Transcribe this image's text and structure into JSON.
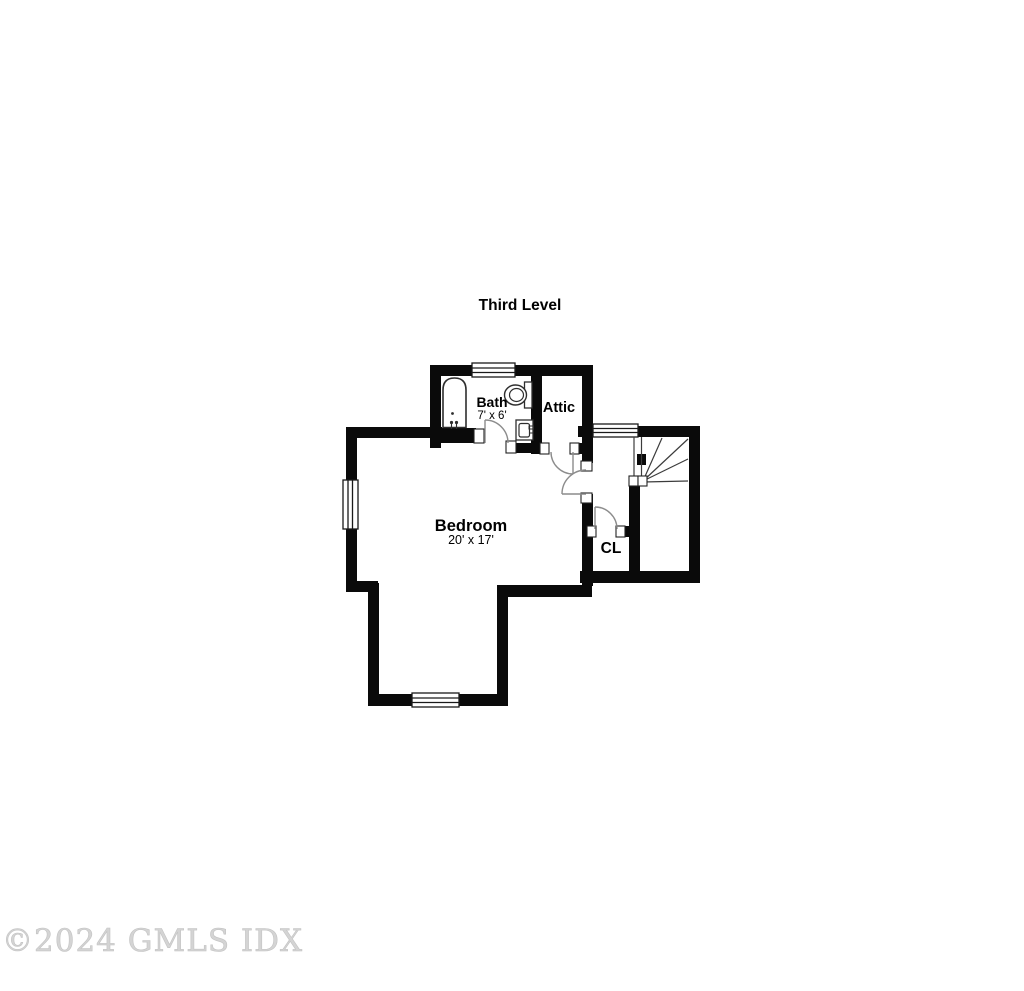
{
  "plan": {
    "title": "Third Level",
    "rooms": {
      "bath": {
        "label": "Bath",
        "dims": "7' x 6'"
      },
      "attic": {
        "label": "Attic"
      },
      "bedroom": {
        "label": "Bedroom",
        "dims": "20' x 17'"
      },
      "closet": {
        "label": "CL"
      }
    },
    "fixtures": {
      "bathtub": "bathtub-icon",
      "toilet": "toilet-icon",
      "sink": "sink-icon",
      "stairs": "winder-stairs-icon"
    },
    "counts": {
      "windows": "4",
      "doors": "4"
    },
    "colors": {
      "wall": "#0a0a0a",
      "door_swing": "#8c8c8c",
      "stair_line": "#3c3c3c",
      "fixture_line": "#2e2e2e",
      "watermark": "#d4d4d4"
    }
  },
  "watermark": "©2024 GMLS IDX"
}
